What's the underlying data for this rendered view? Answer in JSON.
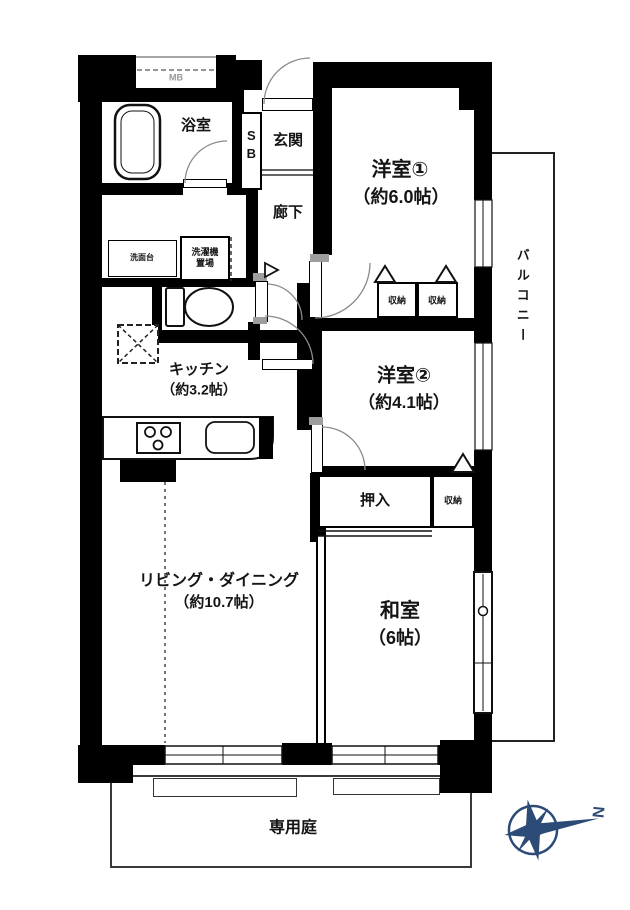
{
  "floorplan": {
    "background": "#ffffff",
    "wall_color": "#000000",
    "line_color": "#333333",
    "labels": {
      "meter_box": "MB",
      "bathroom": "浴室",
      "shoe_box": "SB",
      "entrance": "玄関",
      "hallway": "廊下",
      "western_room_1": "洋室①",
      "western_room_1_size": "（約6.0帖）",
      "closet_1": "収納",
      "closet_2": "収納",
      "balcony": "バルコニー",
      "western_room_2": "洋室②",
      "western_room_2_size": "（約4.1帖）",
      "vanity": "洗面台",
      "laundry": "洗濯機置場",
      "kitchen": "キッチン",
      "kitchen_size": "（約3.2帖）",
      "oshiire": "押入",
      "closet_3": "収納",
      "living_dining": "リビング・ダイニング",
      "living_dining_size": "（約10.7帖）",
      "japanese_room": "和室",
      "japanese_room_size": "（6帖）",
      "private_garden": "専用庭"
    },
    "compass": {
      "letter": "N",
      "color": "#2d4b77"
    }
  }
}
